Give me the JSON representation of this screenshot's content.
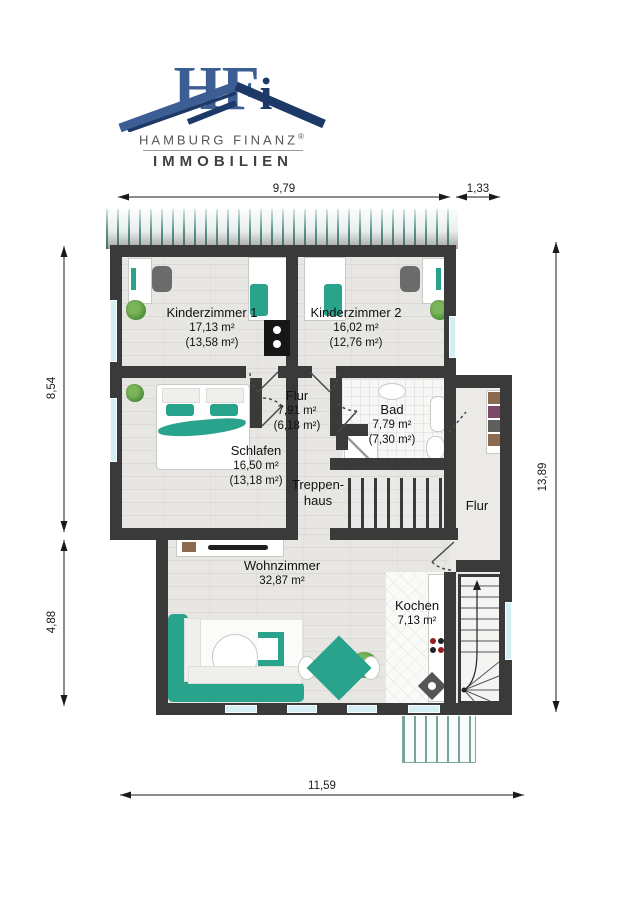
{
  "logo": {
    "monogram": {
      "h": "H",
      "f": "F",
      "i": "i"
    },
    "company": "HAMBURG FINANZ",
    "registered": "®",
    "division": "IMMOBILIEN",
    "colors": {
      "navy": "#1c3968",
      "blue": "#3d5e95",
      "text_gray": "#55565a"
    }
  },
  "dimensions": {
    "top_main": "9,79",
    "top_right": "1,33",
    "left_upper": "8,54",
    "left_lower": "4,88",
    "right_side": "13,89",
    "bottom": "11,59"
  },
  "rooms": {
    "kinderzimmer1": {
      "name": "Kinderzimmer 1",
      "area": "17,13 m²",
      "area_reduced": "(13,58 m²)"
    },
    "kinderzimmer2": {
      "name": "Kinderzimmer 2",
      "area": "16,02 m²",
      "area_reduced": "(12,76 m²)"
    },
    "flur": {
      "name": "Flur",
      "area": "7,91 m²",
      "area_reduced": "(6,18 m²)"
    },
    "bad": {
      "name": "Bad",
      "area": "7,79 m²",
      "area_reduced": "(7,30 m²)"
    },
    "schlafen": {
      "name": "Schlafen",
      "area": "16,50 m²",
      "area_reduced": "(13,18 m²)"
    },
    "treppenhaus": {
      "name_line1": "Treppen-",
      "name_line2": "haus"
    },
    "flur_right": {
      "name": "Flur"
    },
    "wohnzimmer": {
      "name": "Wohnzimmer",
      "area": "32,87 m²"
    },
    "kochen": {
      "name": "Kochen",
      "area": "7,13 m²"
    }
  },
  "colors": {
    "accent_teal": "#2aa38c",
    "wall": "#3a3a3a",
    "window_blue": "#d5eef3",
    "floor_gray": "#e7e6e3"
  }
}
